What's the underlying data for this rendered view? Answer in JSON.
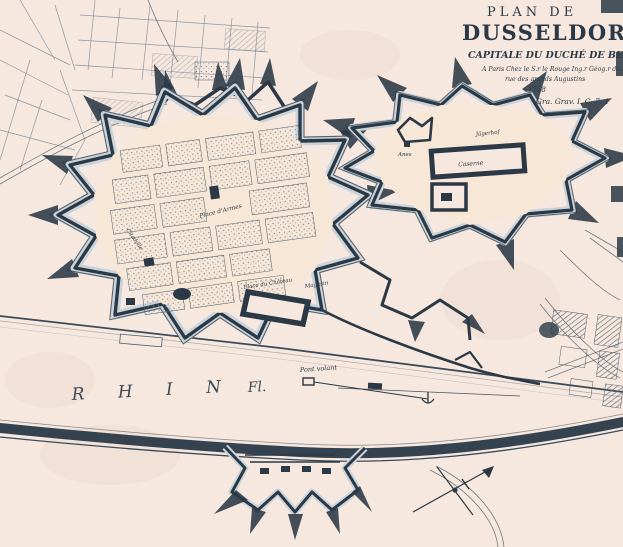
{
  "title_block": {
    "series": "PLAN DE",
    "city": "DUSSELDORP.",
    "subtitle": "CAPITALE DU DUCHÉ DE BERG",
    "imprint": "A Paris Chez le S.r le Rouge Ing.r Géog.r du Roy",
    "address": "rue des grands Augustins",
    "year": "1758",
    "plate_mark": "Gra. Grav.  I. C. 7. 1"
  },
  "river": {
    "name": "R H I N",
    "suffix": "Fl.",
    "ferry_label": "Pont volant"
  },
  "city_labels": {
    "place_darmes": "Place d'Armes",
    "place_du_chateau": "Place du Château",
    "magasin": "Magasin",
    "citadelle": "Citadelle"
  },
  "citadel_labels": {
    "caserne": "Caserne",
    "jagerhof": "Jägerhof",
    "anes": "Anes"
  },
  "colors": {
    "paper": "#f6e8de",
    "interior": "#f7e7d7",
    "ink": "#2b3845",
    "shade": "#4e5e6e",
    "linegray": "#7c8a99",
    "moat": "#c9d3d9",
    "waterline": "#3b4a59"
  }
}
